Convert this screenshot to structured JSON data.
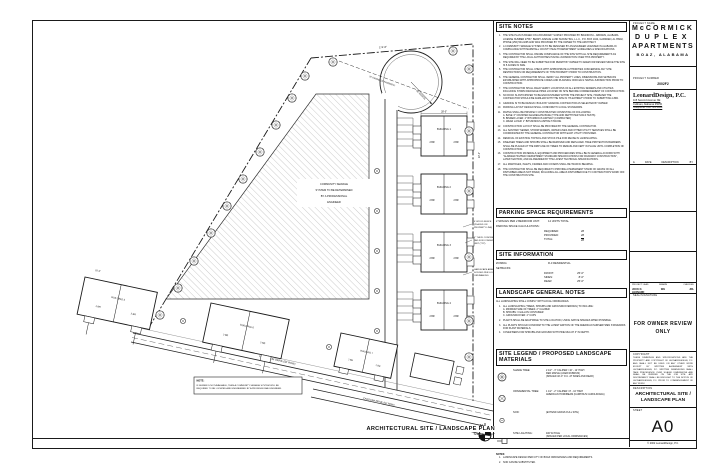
{
  "sheet": {
    "bottom_title": "ARCHITECTURAL SITE / LANDSCAPE PLAN",
    "bottom_scale": "Scale: 1\" = 20'-0\"",
    "north_label": "N"
  },
  "title_block": {
    "project_name_label": "PROJECT NAME",
    "project_name_1": "McCORMICK",
    "project_name_2": "DUPLEX",
    "project_name_3": "APARTMENTS",
    "project_city": "BOAZ, ALABAMA",
    "project_number_label": "PROJECT NUMBER",
    "project_number": "2002F2",
    "firm_name": "LeonardDesign, P.C.",
    "firm_address_1": "115 Second Avenue NE",
    "firm_address_2": "Cullman, Alabama 35055",
    "firm_phone": "Telephone: 256.739.1830",
    "rev_delta": "Δ",
    "rev_date_label": "DATE",
    "rev_desc_label": "DESCRIPTION",
    "rev_by_label": "BY",
    "lead_label": "PROJECT LEAD",
    "drawn_label": "DRAWN",
    "checked_label": "CHECKED",
    "lead_value": "JOCK D. LEONARD",
    "drawn_value": "WH",
    "checked_value": "JDL",
    "seal_label": "SEAL/SIGNATURE",
    "stamp_line_1": "FOR OWNER REVIEW",
    "stamp_line_2": "ONLY",
    "copyright_label": "COPYRIGHT",
    "copyright_text": "THESE DRAWINGS AND SPECIFICATIONS ARE THE PROPERTY AND COPYRIGHT OF LEONARDDESIGN, P.C. AND SHALL NOT BE USED ON ANY OTHER WORK EXCEPT BY WRITTEN AGREEMENT WITH LEONARDDESIGN, P.C. WRITTEN DIMENSIONS SHALL TAKE PRECEDENCE OVER SCALED DIMENSIONS AND SHALL BE VERIFIED ON THE JOB SITE. ANY DISCREPANCY SHALL BE BROUGHT TO THE NOTICE OF LEONARDDESIGN, P.C. PRIOR TO COMMENCEMENT OF ANY WORK.",
    "description_label": "DESCRIPTION",
    "description_line_1": "ARCHITECTURAL SITE /",
    "description_line_2": "LANDSCAPE PLAN",
    "sheet_label": "SHEET",
    "sheet_number": "A0",
    "footer": "© 2002 LeonardDesign, P.C."
  },
  "site_notes": {
    "title": "SITE NOTES",
    "items": [
      "THE SITE PLAN IS BASED ON A BOUNDARY SURVEY PROVIDED BY BRANDON L. ABRAMS, ALABAMA LICENSE NUMBER 27537, BERRY AVENUE LAND SURVEYING, L.L.C., P.O. BOX 1044, GADSDEN, AL 35902, PHONE (256) 504-0295 AND WAS PROVIDED BY THE OWNER TO THE ARCHITECT.",
      "A COMMUNITY SEWAGE SYSTEM IS TO BE DESIGNED BY AN ENGINEER LICENSED IN ALABAMA IN COMPLIANCE WITH MARSHALL COUNTY HEALTH DEPARTMENT GUIDELINES & SPECIFICATIONS.",
      "THE CONTRACTOR SHALL INSURE COMPLIANCE OF THE SITE WITH ALL SITE REQUIREMENTS AS REQUIRED BY THE LOCAL AUTHORITIES HAVING JURISDICTION OVER THIS PROPERTY.",
      "THE SITE WILL NEED TO BE SUBMITTED FOR PERMIT BY OWNER TO ADEM FOR REVIEW SINCE THE SITE IS 5 ACRES IN SIZE.",
      "THE CONTRACTOR SHALL CHECK WITH APPROPRIATE AUTHORITIES CONCERNING ANY SITE RESTRICTIONS OR REQUIREMENTS OF THIS PROPERTY PRIOR TO CONSTRUCTION.",
      "THE GENERAL CONTRACTOR SHALL VERIFY ALL PROPERTY LINES, DIMENSIONS AND SETBACKS ESTABLISHED WITH APPROPRIATE CODES AND PLANNING OFFICIALS HAVING JURISDICTION PRIOR TO CONSTRUCTION.",
      "THE CONTRACTOR SHALL FIELD VERIFY LOCATIONS OF ALL EXISTING SEWERS AND UTILITIES INCLUDING STORM DRAINAGE PIPES LOCATED ON SITE BEFORE COMMENCEMENT OF CONSTRUCTION.",
      "NO ROCK IS ANTICIPATED TO BE ENCOUNTERED WITHIN THE PROJECT SITE, HOWEVER THE CONTRACTOR SHOULD BE FAMILIAR WITH THE SITE IN ITS ENTIRETY PRIOR TO SUBMITTING A BID.",
      "GRADING IS TO BE DESIGN / BUILD BY GRADING CONTRACTOR AS SELECTED BY OWNER.",
      "PARKING LAYOUT DESIGN SHALL CONFORM TO LOCAL STANDARDS.",
      "PAVING SHALL BE PRIVATELY CONSTRUCTED CONSISTING OF FOLLOWING:\nA.   BASE: 6\" CRUSHED AGGREGATE BASE (TYPE AND DEPTH PER SOILS TESTS)\nB.   BINDER LAYER: 2\" BITUMINOUS ASPHALT (COMPACTED)\nC.   WEAR LAYER: 1\" BITUMINOUS ASPHALT PAVING",
      "CONSTRUCTION LAYOUT SHALL BE PROVIDED BY THE GENERAL CONTRACTOR.",
      "ALL SANITARY SEWER, STORM SEWERS, WATER LINES AND OTHER UTILITY SERVICES SHALL BE COORDINATED BY THE GENERAL CONTRACTOR WITH EACH UTILITY PROVIDER.",
      "REMOVAL OF EXISTING TOPSOIL AND STOCK PILE FOR REUSE IN LANDSCAPING.",
      "DISEASED TREES AND SHRUBS SHALL BE REMOVED AND REPLACED. TREE PROTECTION BARRIERS SHALL BE PLACED AT THE DRIP LINE OF TREES TO REMAIN AND KEPT IN PLACE UNTIL COMPLETION OF CONSTRUCTION.",
      "CONSTRUCTION MATERIALS, EQUIPMENT AND PROCEDURES SHALL BE IN GENERAL ACCORD WITH \"ALABAMA HIGHWAY DEPARTMENT STANDARD SPECIFICATIONS FOR ROADWAY CONSTRUCTION\", LATEST EDITION, AND AS AMENDED BY THE LATEST TECHNICAL SPECIFICATIONS.",
      "ALL MANHOLES, INLETS, FRAMES AND COVERS SHALL BE TRAFFIC BEARING.",
      "THE CONTRACTOR SHALL BE REQUIRED TO PROVIDE A PERMANENT STAND OF GRASS ON ALL DISTURBED AREAS NOT PAVED, INCLUDING ALL AREAS DISTURBED DUE TO CONTRACTOR'S WORK OFF THE CONSTRUCTION SITE."
    ]
  },
  "parking": {
    "title": "PARKING SPACE REQUIREMENTS",
    "ratio_label": "2 SPACES PER 2 BEDROOM UNIT:",
    "ratio_value": "14 UNITS TOTAL",
    "calc_label": "PARKING SPACE CALCULATIONS:",
    "rows": [
      {
        "label": "REQUIRED:",
        "value": "28"
      },
      {
        "label": "PROVIDED:",
        "value": "28"
      },
      {
        "label": "TOTAL:",
        "value": "28"
      }
    ]
  },
  "site_info": {
    "title": "SITE INFORMATION",
    "zoning_label": "ZONING:",
    "zoning_value": "R-3 RESIDENTIAL",
    "setbacks_label": "SETBACKS:",
    "setbacks": [
      {
        "label": "FRONT:",
        "value": "25'-0\""
      },
      {
        "label": "SIDES:",
        "value": "8'-0\""
      },
      {
        "label": "REAR:",
        "value": "25'-0\""
      }
    ]
  },
  "landscape_notes": {
    "title": "LANDSCAPE GENERAL NOTES",
    "intro": "ALL LANDSCAPING SHALL COMPLY WITH LOCAL ORDINANCES.",
    "items": [
      "ALL LANDSCAPING (TREES, SHRUBS AND GROUNDCOVERINGS) TO INCLUDE:\nA.   MINIMUM SIZE OF TREES:   2\" CALIPER\nB.   SHRUBS:   3 GALLON CONTAINER\nC.   GROUNDCOVER:   4\" CUPS",
      "PLANTS SHALL BE ADAPTABLE TO SITE LOCATION, USING NATIVE SPECIES WHEN POSSIBLE.",
      "ALL PLANTS SHOULD CONFORM TO THE LATEST EDITION OF THE AMERICAN NURSERYMEN STANDARDS FOR PLANT MATERIALS.",
      "COVER BEDS FOR SHRUBS AND GROUND WITH PINE MULCH 3\" IN DEPTH."
    ]
  },
  "legend": {
    "title": "SITE LEGEND / PROPOSED LANDSCAPE MATERIALS",
    "items": [
      {
        "label": "SHADE TREE:",
        "desc": "2 1/2\" - 3\" CALIPER / 10' - 12' HIGH\nRED MAPLE (ACER RUBRUM)\n(SPACED 40'-0\" O.C. AT SIDES AND REAR)"
      },
      {
        "label": "ORNAMENTAL TREE:",
        "desc": "1 1/2\" - 2\" CALIPER / 8' - 10' HIGH\nAMERICAN HORNBEAM (CARPINUS CAROLINIANA)"
      },
      {
        "label": "SOD:",
        "desc": "(EXTEND GRASS FULL SITE)"
      },
      {
        "label": "SITE LIGHTING:",
        "desc": "400 W POLE\n(SPACED PER LOCAL ORDINANCES)"
      }
    ],
    "notes_label": "NOTES:",
    "notes": [
      "LANDSCAPE DESIGN PER CITY OF BOAZ ORDINANCES AND REQUIREMENTS.",
      "SOD CAN BE SUBSTITUTED."
    ]
  },
  "plan": {
    "community_lines": [
      "COMMUNITY SEWAGE",
      "SYSTEM TO BE DETERMINED",
      "BY A PROFESSIONAL",
      "ENGINEER"
    ],
    "note_box_title": "NOTE:",
    "note_box_lines": [
      "IF SEWER IS NOT AVAILABLE, THEN A COMMUNITY SEWAGE SYSTEM WILL BE",
      "REQUIRED TO BE LOCATED AND ENGINEERED BY A PROFESSIONAL ENGINEER."
    ],
    "radius_label": "60' RADIUS",
    "easement_label": "20' DRAINAGE EASEMENT",
    "patterson_label": "PATTERSON DRIVE (50' ROW)",
    "carolina_label": "CAROLINA DRIVE (50' ROW)",
    "sidewalk_lines": [
      "5' CONCRETE SIDEWALK",
      "SYSTEM (TYP) CURB & GUTTER"
    ],
    "fence_lines": [
      "6' WOOD FENCE",
      "(PLACED ON",
      "PROPERTY LINE)"
    ],
    "condenser_lines": [
      "4\" THICK CONCRETE",
      "PAD FOR CONDENSER",
      "UNIT (TYP)"
    ],
    "landscape_lines": [
      "LANDSCAPE AREA",
      "SODDED PER LOCAL",
      "ORDINANCES"
    ],
    "buildings": [
      "BUILDING 1",
      "BUILDING 2",
      "BUILDING 3",
      "BUILDING 4",
      "BUILDING 5",
      "BUILDING 6",
      "BUILDING 7"
    ],
    "unit_label": "2 BR",
    "dims": {
      "top": "174'-8\"",
      "bldg_w": "28'-0\"",
      "bldg_gap": "22'-0\"",
      "front": "25'-0\""
    }
  }
}
